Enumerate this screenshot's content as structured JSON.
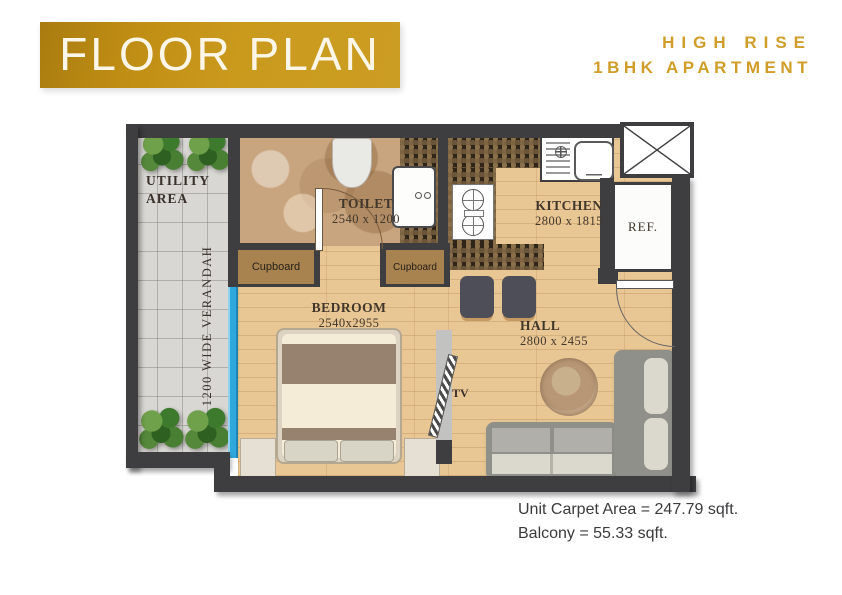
{
  "colors": {
    "accent_gold": "#C9951C",
    "wall": "#3E3E40",
    "window_blue": "#2FA9DC",
    "wood_floor": "#E9C795",
    "banner_text": "#FBF6E8"
  },
  "header": {
    "title": "FLOOR PLAN",
    "building": "HIGH RISE",
    "unit_type": "1BHK APARTMENT"
  },
  "rooms": {
    "utility": {
      "label": "UTILITY\nAREA"
    },
    "verandah": {
      "label": "1200 WIDE VERANDAH"
    },
    "toilet": {
      "name": "TOILET",
      "dims": "2540 x 1200"
    },
    "kitchen": {
      "name": "KITCHEN",
      "dims": "2800 x 1815"
    },
    "bedroom": {
      "name": "BEDROOM",
      "dims": "2540x2955"
    },
    "hall": {
      "name": "HALL",
      "dims": "2800 x 2455"
    }
  },
  "fixtures": {
    "cupboard_left": "Cupboard",
    "cupboard_right": "Cupboard",
    "refrigerator": "REF.",
    "tv": "TV"
  },
  "footer": {
    "carpet_area": "Unit Carpet Area = 247.79 sqft.",
    "balcony_area": "Balcony = 55.33 sqft."
  }
}
